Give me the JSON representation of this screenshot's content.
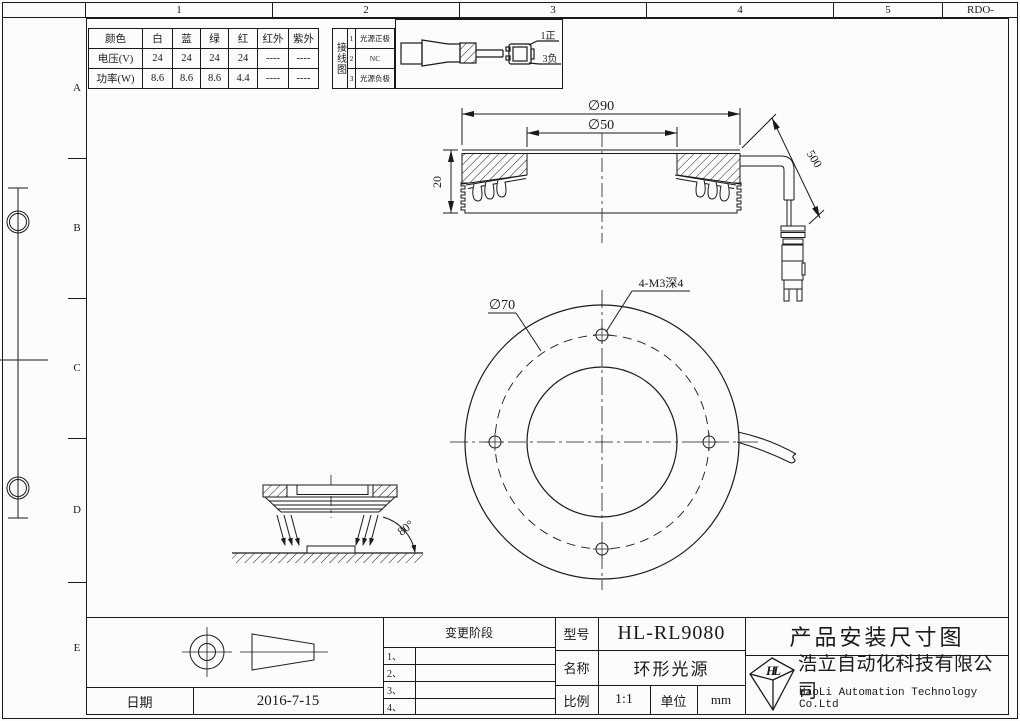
{
  "colors": {
    "ink": "#1a1a1a",
    "paper": "#fcfcfc"
  },
  "zones": {
    "top": [
      "1",
      "2",
      "3",
      "4",
      "5"
    ],
    "corner": "RDO-",
    "left": [
      "A",
      "B",
      "C",
      "D",
      "E"
    ]
  },
  "spec_table": {
    "header_label": "颜色",
    "columns": [
      "白",
      "蓝",
      "绿",
      "红",
      "红外",
      "紫外"
    ],
    "rows": [
      {
        "label": "电压(V)",
        "values": [
          "24",
          "24",
          "24",
          "24",
          "----",
          "----"
        ]
      },
      {
        "label": "功率(W)",
        "values": [
          "8.6",
          "8.6",
          "8.6",
          "4.4",
          "----",
          "----"
        ]
      }
    ]
  },
  "wiring": {
    "title": "接线图",
    "pins": [
      {
        "no": "1",
        "label": "光源正极"
      },
      {
        "no": "2",
        "label": "NC"
      },
      {
        "no": "3",
        "label": "光源负极"
      }
    ],
    "plug": {
      "pin1": "1正",
      "pin3": "3负"
    }
  },
  "dimensions": {
    "outer_diameter": "∅90",
    "inner_diameter": "∅50",
    "height": "20",
    "cable_length": "500",
    "bolt_circle": "∅70",
    "mounting_holes": "4-M3深4",
    "beam_angle": "80°"
  },
  "title_block": {
    "change_stage_label": "变更阶段",
    "change_rows": [
      "1、",
      "2、",
      "3、",
      "4、"
    ],
    "model_label": "型号",
    "model_value": "HL-RL9080",
    "name_label": "名称",
    "name_value": "环形光源",
    "scale_label": "比例",
    "scale_value": "1:1",
    "unit_label": "单位",
    "unit_value": "mm",
    "date_label": "日期",
    "date_value": "2016-7-15",
    "drawing_title": "产品安装尺寸图",
    "company_cn": "浩立自动化科技有限公司",
    "company_en": "HaoLi Automation Technology Co.Ltd",
    "logo_monogram": "HL"
  }
}
